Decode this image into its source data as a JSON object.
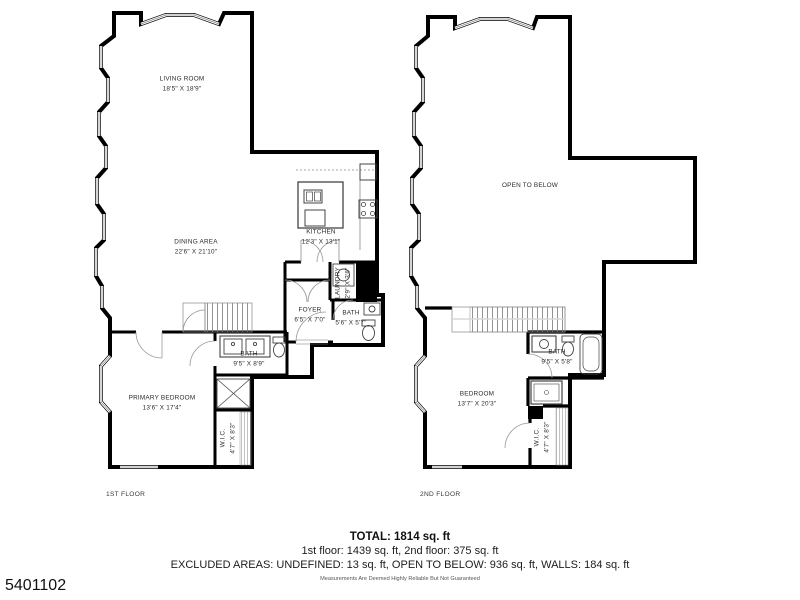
{
  "photo_id": "5401102",
  "colors": {
    "walls": "#000000",
    "text": "#2b2b2b"
  },
  "floors": [
    {
      "name": "1ST FLOOR",
      "rooms": {
        "living": {
          "label": "LIVING ROOM",
          "dims": "18'5\" X 18'9\""
        },
        "dining": {
          "label": "DINING AREA",
          "dims": "22'6\" X 21'10\""
        },
        "kitchen": {
          "label": "KITCHEN",
          "dims": "12'3\" X 13'1\""
        },
        "foyer": {
          "label": "FOYER",
          "dims": "6'5\" X 7'0\""
        },
        "laundry": {
          "label": "LAUNDRY",
          "dims": "2'9\" X 3'6\""
        },
        "bath_small": {
          "label": "BATH",
          "dims": "5'6\" X 5'7\""
        },
        "bath_main": {
          "label": "BATH",
          "dims": "9'5\" X 8'9\""
        },
        "primary": {
          "label": "PRIMARY BEDROOM",
          "dims": "13'6\" X 17'4\""
        },
        "wic": {
          "label": "W.I.C.",
          "dims": "4'7\" X 8'3\""
        }
      }
    },
    {
      "name": "2ND FLOOR",
      "rooms": {
        "open_below": {
          "label": "OPEN TO BELOW",
          "dims": ""
        },
        "bedroom": {
          "label": "BEDROOM",
          "dims": "13'7\" X 20'3\""
        },
        "bath": {
          "label": "BATH",
          "dims": "9'5\" X 5'8\""
        },
        "wic": {
          "label": "W.I.C.",
          "dims": "4'7\" X 8'3\""
        }
      }
    }
  ],
  "summary": {
    "total": "TOTAL: 1814 sq. ft",
    "floors_line": "1st floor: 1439 sq. ft, 2nd floor: 375 sq. ft",
    "excluded_line": "EXCLUDED AREAS: UNDEFINED: 13 sq. ft, OPEN TO BELOW: 936 sq. ft, WALLS: 184 sq. ft",
    "disclaimer": "Measurements Are Deemed Highly Reliable But Not Guaranteed"
  }
}
